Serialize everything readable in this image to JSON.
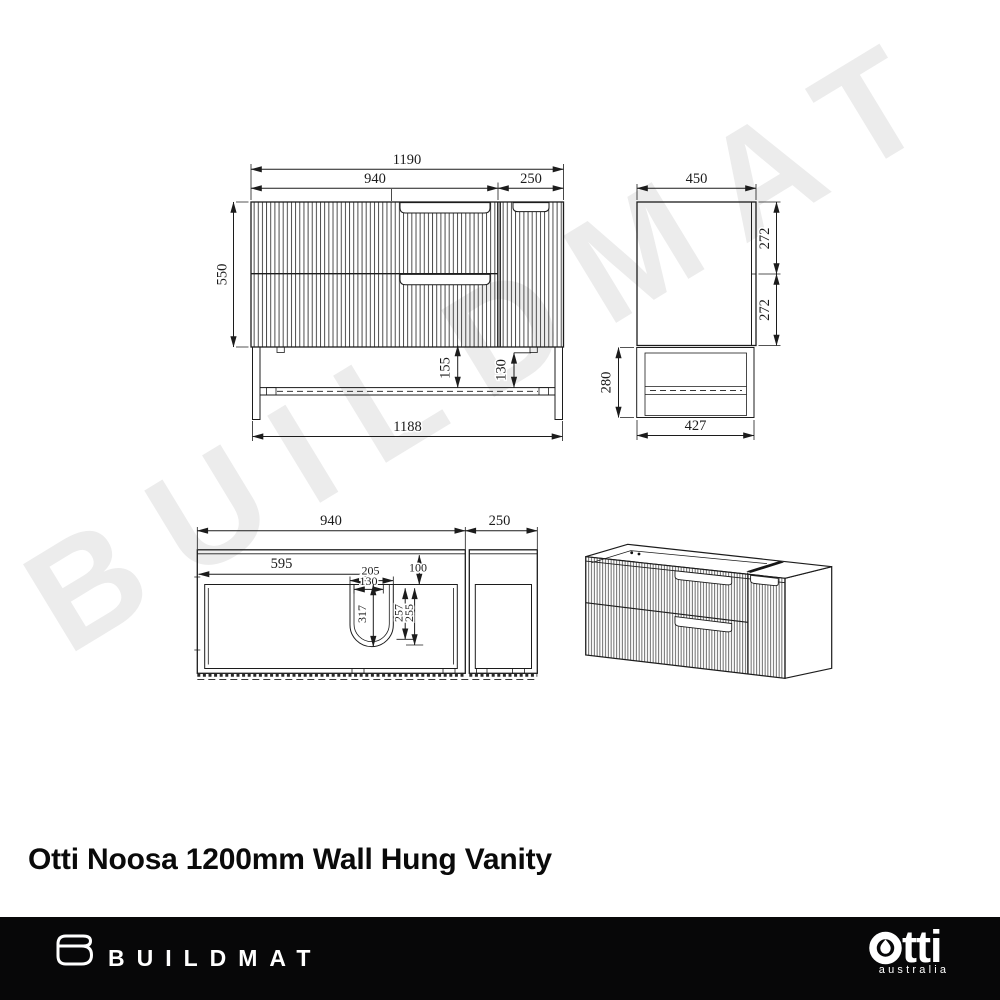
{
  "watermark": "BUILDMAT",
  "title": "Otti Noosa 1200mm Wall Hung Vanity",
  "views": {
    "front": {
      "dims": {
        "overall_width": "1190",
        "drawer_section_width": "940",
        "door_section_width": "250",
        "cabinet_height": "550",
        "frame_inner_height": "155",
        "shelf_rail_height": "130",
        "frame_width": "1188"
      }
    },
    "side": {
      "dims": {
        "depth": "450",
        "top_drawer_height": "272",
        "bottom_drawer_height": "272",
        "frame_height": "280",
        "frame_depth": "427"
      }
    },
    "plan": {
      "dims": {
        "benchtop_width": "940",
        "door_top_width": "250",
        "basin_centre_offset": "595",
        "basin_cutout_width": "205",
        "basin_inner_width": "130",
        "front_edge_inset": "100",
        "basin_cutout_length": "317",
        "basin_depth_outer": "257",
        "basin_depth_inner": "255"
      }
    }
  },
  "footer": {
    "buildmat": "BUILDMAT",
    "otti": "otti",
    "otti_suffix": "tti",
    "otti_sub": "australia"
  }
}
